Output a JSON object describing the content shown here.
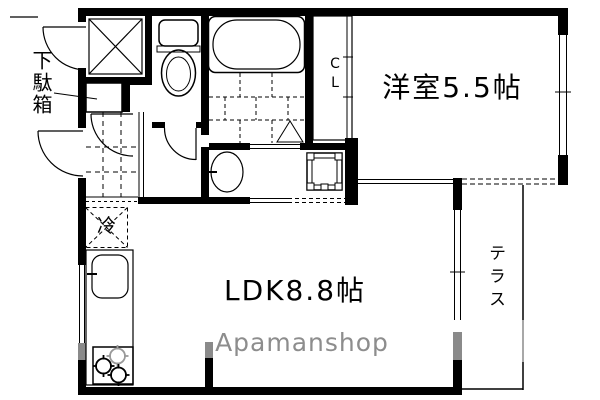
{
  "labels": {
    "shoe_cabinet": "下駄箱",
    "closet": "CL",
    "western_room": "洋室5.5帖",
    "ldk": "LDK8.8帖",
    "refrigerator": "冷",
    "terrace": "テラス",
    "watermark": "Apamanshop"
  },
  "fixtures": {
    "storage_box": "x-cross-storage",
    "toilet": "toilet-icon",
    "bathtub": "bathtub-icon",
    "shower": "shower-triangle-icon",
    "washbasin": "washbasin-icon",
    "washing_machine_pan": "washing-machine-pan-icon",
    "refrigerator_space": "refrigerator-space-icon",
    "kitchen_sink": "sink-icon",
    "stove": "three-burner-stove-icon",
    "shoe_box": "shoe-box-icon",
    "entrance_tile": "genkan-tile-grid",
    "bathroom_tile": "bath-tile-grid"
  },
  "colors": {
    "wall": "#000000",
    "background": "#ffffff",
    "watermark_gray": "#8d8d8d",
    "burner_gray": "#9a9a9a",
    "window_gray": "#8a8a8a"
  }
}
